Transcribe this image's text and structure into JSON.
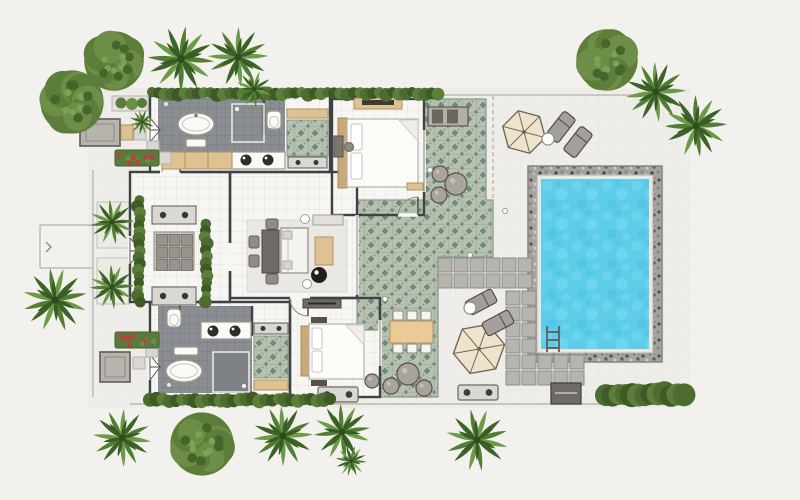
{
  "plan": {
    "type": "villa-floor-plan",
    "features": [
      "two-bedroom-suites",
      "two-bathrooms",
      "living-room",
      "ornamental-decks",
      "swimming-pool",
      "pool-ladder",
      "sun-umbrellas",
      "loungers",
      "outdoor-dining",
      "garden-trees"
    ]
  },
  "palette": {
    "bg": "#f2f1ee",
    "terrace": "#efede9",
    "floor": "#f7f6f2",
    "darktile": "#8a8d91",
    "wall": "#3f4245",
    "deck": "#b7c1b0",
    "deckmotif": "#5e8177",
    "water": "#5ecdea",
    "stone": "#a5a39e",
    "paver": "#b6b4af",
    "paverline": "#8d8b86",
    "wood": "#ddc294",
    "woodlight": "#ecca97",
    "hedge": "#4c6c30",
    "bushy1": "#5d7d3a",
    "bushy2": "#6d8e47",
    "palm1": "#527e33",
    "palm2": "#6b9b46",
    "palmdark": "#3c6426",
    "cream": "#efe3cb",
    "lounger": "#a39f99",
    "red": "#b8423c"
  },
  "scene": {
    "trees": [
      {
        "type": "bushy",
        "x": 72,
        "y": 102,
        "r": 34
      },
      {
        "type": "bushy",
        "x": 114,
        "y": 61,
        "r": 32
      },
      {
        "type": "palm",
        "x": 181,
        "y": 59,
        "r": 34
      },
      {
        "type": "palm",
        "x": 238,
        "y": 57,
        "r": 31
      },
      {
        "type": "palm",
        "x": 254,
        "y": 89,
        "r": 19
      },
      {
        "type": "bushy",
        "x": 607,
        "y": 60,
        "r": 33
      },
      {
        "type": "palm",
        "x": 656,
        "y": 92,
        "r": 31
      },
      {
        "type": "palm",
        "x": 696,
        "y": 126,
        "r": 32
      },
      {
        "type": "palm",
        "x": 55,
        "y": 300,
        "r": 33
      },
      {
        "type": "palm",
        "x": 112,
        "y": 222,
        "r": 23
      },
      {
        "type": "palm",
        "x": 112,
        "y": 287,
        "r": 23
      },
      {
        "type": "palm",
        "x": 142,
        "y": 122,
        "r": 13
      },
      {
        "type": "palm",
        "x": 122,
        "y": 438,
        "r": 30
      },
      {
        "type": "bushy",
        "x": 202,
        "y": 444,
        "r": 34
      },
      {
        "type": "palm",
        "x": 283,
        "y": 436,
        "r": 31
      },
      {
        "type": "palm",
        "x": 342,
        "y": 432,
        "r": 29
      },
      {
        "type": "palm",
        "x": 351,
        "y": 461,
        "r": 16
      },
      {
        "type": "palm",
        "x": 477,
        "y": 440,
        "r": 32
      }
    ],
    "paver_blocks": [
      {
        "x": 438,
        "y": 258,
        "cols": 6,
        "rows": 2,
        "cell": 14,
        "gap": 2
      },
      {
        "x": 506,
        "y": 291,
        "cols": 2,
        "rows": 6,
        "cell": 14,
        "gap": 2
      },
      {
        "x": 538,
        "y": 355,
        "cols": 3,
        "rows": 2,
        "cell": 14,
        "gap": 2
      }
    ],
    "hedges": [
      {
        "x": 152,
        "y": 90,
        "w": 286,
        "h": 7
      },
      {
        "x": 150,
        "y": 396,
        "w": 180,
        "h": 8
      },
      {
        "x": 606,
        "y": 386,
        "w": 78,
        "h": 17
      },
      {
        "x": 136,
        "y": 200,
        "w": 6,
        "h": 102
      },
      {
        "x": 203,
        "y": 224,
        "w": 6,
        "h": 78
      }
    ],
    "flower_planters": [
      {
        "x": 115,
        "y": 150,
        "w": 44,
        "h": 16
      },
      {
        "x": 115,
        "y": 332,
        "w": 44,
        "h": 16
      }
    ],
    "umbrellas": [
      {
        "x": 524,
        "y": 132,
        "r": 22,
        "rot": 15
      },
      {
        "x": 479,
        "y": 349,
        "r": 26,
        "rot": -10
      }
    ],
    "loungers": [
      {
        "x": 561,
        "y": 127,
        "rot": 38
      },
      {
        "x": 578,
        "y": 142,
        "rot": 38
      },
      {
        "x": 481,
        "y": 302,
        "rot": 62
      },
      {
        "x": 498,
        "y": 323,
        "rot": 62
      }
    ],
    "side_tables": [
      {
        "x": 548,
        "y": 139,
        "r": 6
      },
      {
        "x": 470,
        "y": 308,
        "r": 6
      }
    ],
    "poufs": [
      {
        "x": 408,
        "y": 374,
        "r": 11
      },
      {
        "x": 391,
        "y": 386,
        "r": 8
      },
      {
        "x": 424,
        "y": 388,
        "r": 8
      },
      {
        "x": 440,
        "y": 174,
        "r": 8
      },
      {
        "x": 456,
        "y": 184,
        "r": 11
      },
      {
        "x": 439,
        "y": 195,
        "r": 8
      },
      {
        "x": 372,
        "y": 381,
        "r": 7
      }
    ],
    "terrace_benches": [
      {
        "x": 318,
        "y": 387,
        "w": 40,
        "h": 15
      },
      {
        "x": 458,
        "y": 385,
        "w": 40,
        "h": 15
      }
    ],
    "stepping_stones": [
      {
        "x": 134,
        "y": 128
      },
      {
        "x": 147,
        "y": 141
      },
      {
        "x": 159,
        "y": 152
      },
      {
        "x": 133,
        "y": 357
      },
      {
        "x": 146,
        "y": 345
      }
    ],
    "deck_dots": [
      {
        "x": 505,
        "y": 211
      },
      {
        "x": 470,
        "y": 255
      },
      {
        "x": 385,
        "y": 299
      },
      {
        "x": 430,
        "y": 170
      }
    ]
  }
}
